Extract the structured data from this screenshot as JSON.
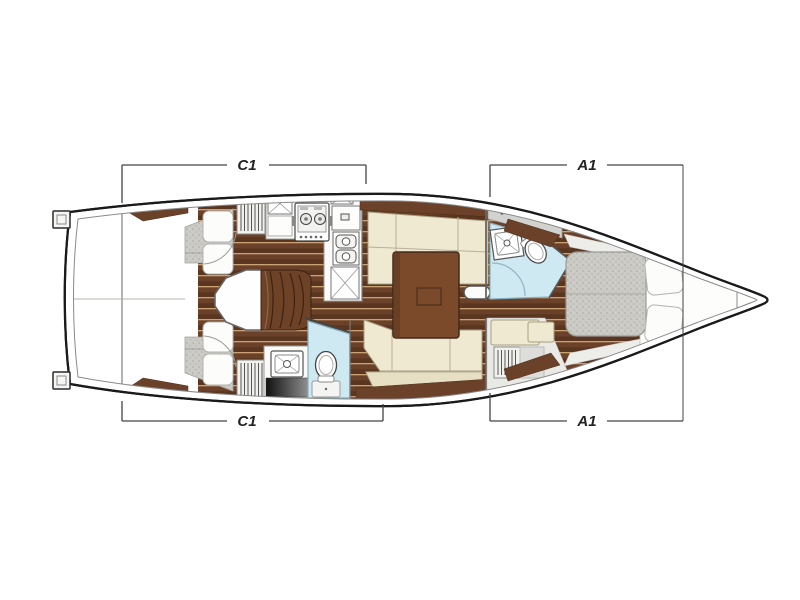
{
  "dimension_labels": {
    "top_left": "C1",
    "top_right": "A1",
    "bottom_left": "C1",
    "bottom_right": "A1"
  },
  "colors": {
    "hull_line": "#1a1a1a",
    "inner_deck_line": "#8a8a8a",
    "wood_trim": "#6b4129",
    "table_wood": "#7a4a2b",
    "cream": "#efe9d1",
    "cream_shade": "#e6dfc4",
    "cream_border": "#a79e7f",
    "wet_blue": "#cfe9f3",
    "wet_blue_border": "#86aebe",
    "fabric_gray": "#cbcac5",
    "panel_gray": "#d2d2ce",
    "dim_line": "#444444"
  },
  "icons": {
    "stove-icon": "two-burner-circles",
    "sink-icon": "basin-with-drain-circle",
    "toilet-icon": "oval-bowl",
    "steps-icon": "curved-treads",
    "mast-icon": "pill-shape",
    "louvre-locker-icon": "vertical-slats",
    "storage-locker-icon": "x-crosshatch"
  }
}
